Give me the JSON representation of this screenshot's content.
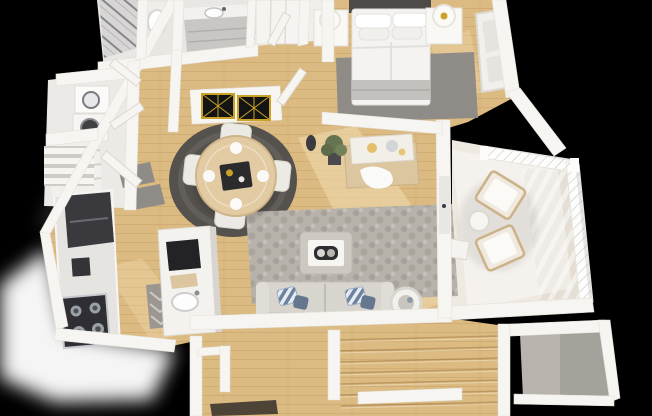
{
  "meta": {
    "description": "3D rendered isometric floor plan of a two-level apartment, no text labels",
    "width": 652,
    "height": 416
  },
  "palette": {
    "bg": "#000000",
    "glow": "#ffffff",
    "wall": "#f7f5f1",
    "wallEdge": "#ddd9d2",
    "wallShade": "#dcd8d1",
    "wood": "#dcbb82",
    "woodLight": "#f0dcb2",
    "plank": "#8a5f2a",
    "bathFloor": "#e9e7e4",
    "marble": "#d8d6d4",
    "rugDark": "#55514d",
    "rugMid": "#8f8b86",
    "rugLight": "#b7b2aa",
    "balcony": "#eee9e1",
    "deck": "#e3ddd2",
    "concrete": "#b8b4ad",
    "dark": "#2e2e32",
    "steel": "#c6c9cd",
    "gold": "#c9a227",
    "sofa": "#d8d5cf",
    "cream": "#eceae4",
    "furnWood": "#dcc6a0",
    "pillowBlue": "#6c82a0",
    "pillowSlate": "#64778f",
    "mat": "#4e4337",
    "plant": "#66744f",
    "white": "#ffffff"
  },
  "scene": {
    "view": "top-down 3D dollhouse render, black background, soft white ground glow at lower left",
    "rooms": [
      {
        "name": "bathroom-suite",
        "position": "top-left",
        "features": [
          "marble shower",
          "toilet",
          "gray vanity with sink",
          "wardrobe closet"
        ]
      },
      {
        "name": "laundry-closet",
        "position": "upper-left",
        "features": [
          "stacked washer and dryer",
          "louvered doors",
          "linen shelves"
        ]
      },
      {
        "name": "kitchen",
        "position": "left",
        "features": [
          "dark refrigerator",
          "stove with 4 burners",
          "island with sink and black panel",
          "gray mat"
        ]
      },
      {
        "name": "dining-area",
        "position": "center-left",
        "features": [
          "round wood table",
          "4 cream chairs",
          "round dark gray rug",
          "black and gold wall mirrors"
        ]
      },
      {
        "name": "living-room",
        "position": "center",
        "features": [
          "gray sofa with blue striped pillows",
          "gray ottoman coffee table with tray",
          "mottled gray area rug",
          "wood media console with artwork",
          "potted plant",
          "round side table"
        ]
      },
      {
        "name": "bedroom",
        "position": "top-right",
        "features": [
          "bed with white duvet and gray throw",
          "dark headboard",
          "2 white nightstands",
          "2 lamps",
          "gray rug",
          "window"
        ]
      },
      {
        "name": "balcony",
        "position": "right",
        "features": [
          "white lattice railing",
          "2 wood lounge chairs with white cushions",
          "round side table",
          "deck boards"
        ]
      },
      {
        "name": "entry-hall",
        "position": "bottom-center",
        "features": [
          "dark brown door mat",
          "coat closet"
        ]
      },
      {
        "name": "stairwell",
        "position": "bottom",
        "features": [
          "wood stair treads descending"
        ]
      },
      {
        "name": "storage-room",
        "position": "bottom-right",
        "features": [
          "concrete floor"
        ]
      }
    ],
    "counts": {
      "dining_chairs": 4,
      "balcony_chairs": 2,
      "nightstands": 2,
      "sofa_pillows": 4,
      "stove_burners": 4
    }
  }
}
